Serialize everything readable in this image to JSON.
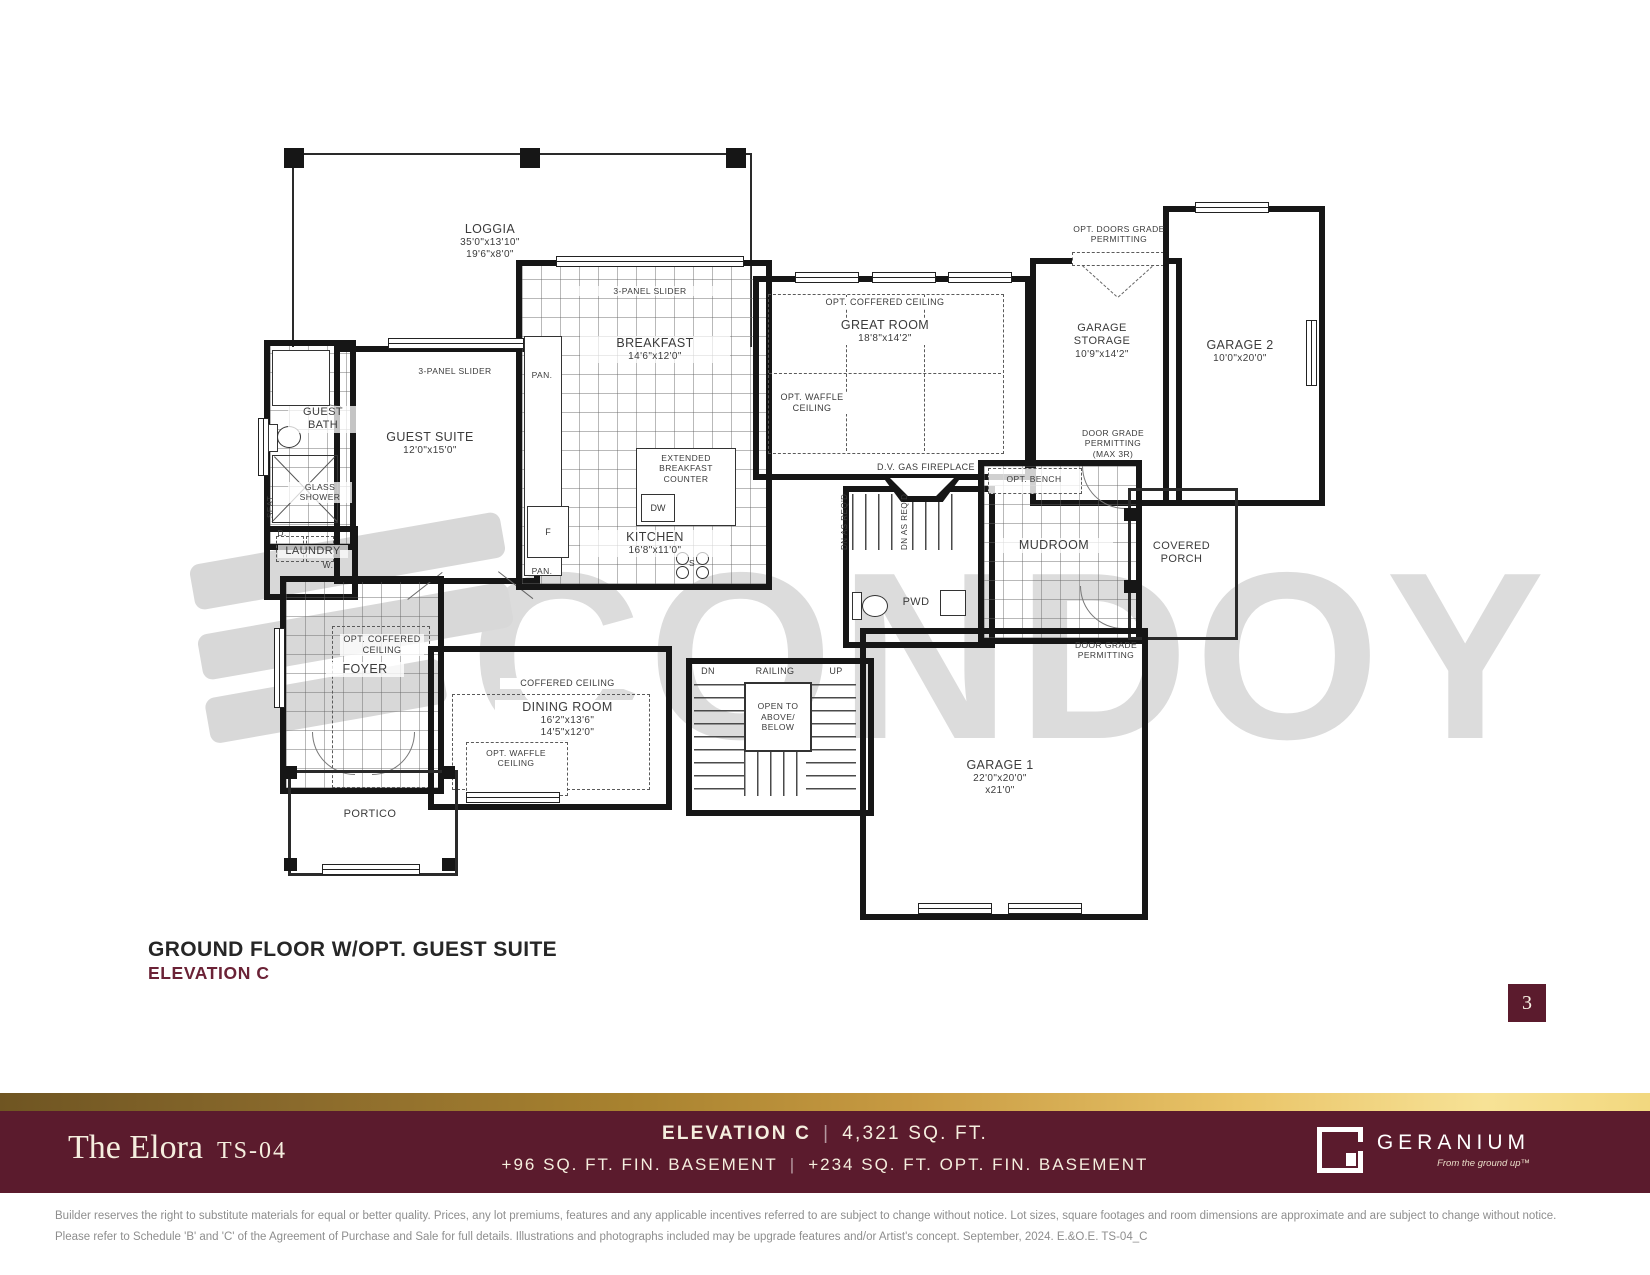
{
  "page": {
    "number": "3",
    "watermark": "CONDOY"
  },
  "title": {
    "line1": "GROUND FLOOR W/OPT. GUEST SUITE",
    "line2": "ELEVATION C"
  },
  "plan": {
    "loggia": {
      "name": "LOGGIA",
      "dim1": "35'0\"x13'10\"",
      "dim2": "19'6\"x8'0\""
    },
    "three_panel_slider": "3-PANEL SLIDER",
    "guest_suite": {
      "name": "GUEST SUITE",
      "dim": "12'0\"x15'0\""
    },
    "guest_bath": "GUEST BATH",
    "glass_shower": "GLASS SHOWER",
    "seat": "SEAT",
    "laundry": "LAUNDRY",
    "dryer": "D.",
    "washer": "W.",
    "breakfast": {
      "name": "BREAKFAST",
      "dim": "14'6\"x12'0\""
    },
    "kitchen": {
      "name": "KITCHEN",
      "dim": "16'8\"x11'0\""
    },
    "extended_counter": "EXTENDED BREAKFAST COUNTER",
    "dw": "DW",
    "fridge": "F",
    "pantry": "PAN.",
    "stove": "S",
    "great_room": {
      "name": "GREAT ROOM",
      "dim": "18'8\"x14'2\""
    },
    "opt_coffered_ceiling": "OPT. COFFERED CEILING",
    "coffered_ceiling": "COFFERED CEILING",
    "opt_waffle_ceiling": "OPT. WAFFLE CEILING",
    "fireplace": "D.V. GAS FIREPLACE",
    "garage_storage": {
      "name": "GARAGE STORAGE",
      "dim": "10'9\"x14'2\""
    },
    "garage2": {
      "name": "GARAGE 2",
      "dim": "10'0\"x20'0\""
    },
    "garage1": {
      "name": "GARAGE 1",
      "dim1": "22'0\"x20'0\"",
      "dim2": "x21'0\""
    },
    "opt_doors_grade": "OPT. DOORS GRADE PERMITTING",
    "door_grade_max3r": "DOOR GRADE PERMITTING (MAX 3R)",
    "door_grade": "DOOR GRADE PERMITTING",
    "mudroom": "MUDROOM",
    "opt_bench": "OPT. BENCH",
    "covered_porch": "COVERED PORCH",
    "pwd": "PWD",
    "dn_as_reqd": "DN AS REQ'D",
    "dining": {
      "name": "DINING ROOM",
      "dim1": "16'2\"x13'6\"",
      "dim2": "14'5\"x12'0\""
    },
    "foyer": "FOYER",
    "portico": "PORTICO",
    "stairs": {
      "dn": "DN",
      "railing": "RAILING",
      "up": "UP",
      "open": "OPEN TO ABOVE/ BELOW"
    }
  },
  "footer": {
    "model_name": "The Elora",
    "model_code": "TS-04",
    "elevation_label": "ELEVATION C",
    "sqft": "4,321 SQ. FT.",
    "basement": "+96 SQ. FT. FIN. BASEMENT",
    "opt_basement": "+234 SQ. FT. OPT. FIN. BASEMENT",
    "brand": "GERANIUM",
    "brand_tagline": "From the ground up™",
    "colors": {
      "maroon": "#5b1b2d",
      "gold": "#c79a42",
      "cream": "#f5eede"
    }
  },
  "disclaimer": {
    "line1": "Builder reserves the right to substitute materials for equal or better quality. Prices, any lot premiums, features and any applicable incentives referred to are subject to change without notice. Lot sizes, square footages and room dimensions are approximate and are subject to change without notice.",
    "line2": "Please refer to Schedule 'B' and 'C' of the Agreement of Purchase and Sale for full details. Illustrations and photographs included may be upgrade features and/or Artist's concept. September, 2024. E.&O.E. TS-04_C"
  }
}
